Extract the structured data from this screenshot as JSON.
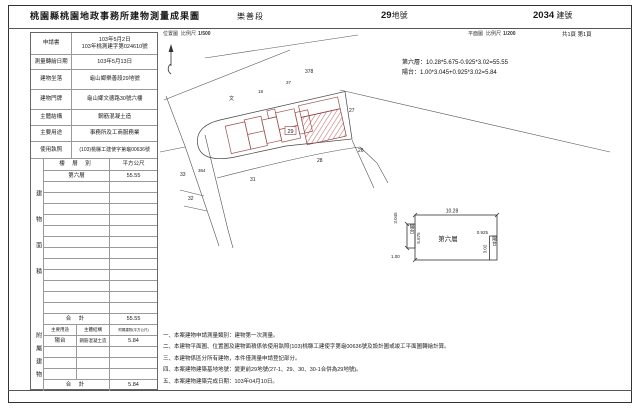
{
  "header": {
    "title": "桃園縣桃園地政事務所建物測量成果圖",
    "section": "樂善段",
    "parcel_number": "29",
    "parcel_unit": "地號",
    "building_number": "2034",
    "building_unit": "建號",
    "location_map_label": "位置圖",
    "location_scale_label": "比例尺",
    "location_scale": "1/500",
    "floor_plan_label": "平面圖",
    "floor_plan_scale_label": "比例尺",
    "floor_plan_scale": "1/200",
    "page_info": "共1頁 第1頁"
  },
  "info_table": {
    "rows": [
      {
        "label": "申請書",
        "value": "103年5月2日",
        "value2": "103年桃測建字第024610號"
      },
      {
        "label": "測量轉繪日期",
        "value": "103年5月13日"
      },
      {
        "label": "建物坐落",
        "value": "龜山鄉樂善段29地號"
      },
      {
        "label": "建物門牌",
        "value": "龜山鄉文德路30號六樓"
      },
      {
        "label": "主體結構",
        "value": "鋼筋混凝土造"
      },
      {
        "label": "主要用途",
        "value": "事務所及工商服務業"
      },
      {
        "label": "使用執照",
        "value": "(103)桃縣工建使字第龜00636號"
      }
    ]
  },
  "area_table": {
    "vertical_label": "建物面積",
    "col_floor": "樓 層 別",
    "col_area": "平方公尺",
    "floor": "第六層",
    "floor_area": "55.55",
    "total_label": "合  計",
    "total": "55.55"
  },
  "annex_table": {
    "vertical_label": "附屬建物",
    "col_use": "主要用途",
    "col_structure": "主體結構",
    "col_area": "附屬建物(平方公尺)",
    "use": "陽台",
    "structure": "鋼筋混凝土造",
    "area": "5.84",
    "total_label": "合  計",
    "total": "5.84"
  },
  "formulas": [
    "第六層：10.28*5.675-0.925*3.02=55.55",
    "陽台：1.00*3.045+0.925*3.02=5.84"
  ],
  "site_plan": {
    "labels": {
      "p378": "378",
      "p37": "37",
      "p18": "18",
      "road_char": "文",
      "p27": "27",
      "p26": "26",
      "p28": "28",
      "p31": "31",
      "p33": "33",
      "p32": "32",
      "p364": "364",
      "subject": "29"
    }
  },
  "floor_plan": {
    "room": "第六層",
    "dim_width": "10.28",
    "dim_height": "5.675",
    "balcony_left": "陽台",
    "balcony_left_width": "1.00",
    "balcony_left_height": "3.045",
    "balcony_right": "陽台",
    "balcony_right_width": "0.925",
    "balcony_right_height": "3.02"
  },
  "notes": [
    "一、本案建物申請測量類別：建物第一次測量。",
    "二、本建物平面圖、位置圖及建物面積係依使用執照(103)桃縣工建使字第龜00636號及設計圖或竣工平面圖轉繪計算。",
    "三、本建物係區分所有建物，本件僅測量申請登記部分。",
    "四、本案建物建築基地地號：變更前29地號(27-1、29、30、30-1合併為29地號)。",
    "五、本案建物建築完成日期：103年04月10日。"
  ]
}
